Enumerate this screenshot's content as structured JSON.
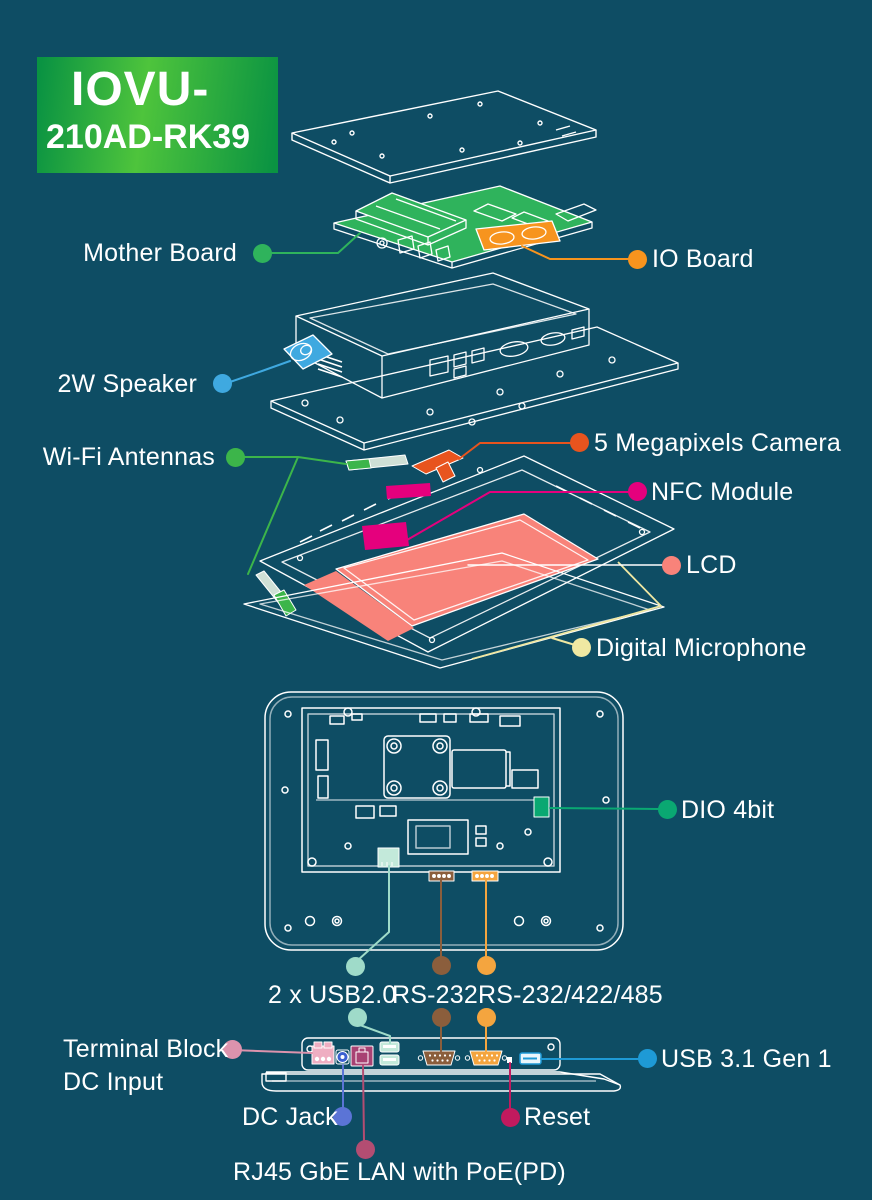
{
  "product_badge": {
    "model_line1": "IOVU-",
    "model_line2": "210AD-RK39"
  },
  "colors": {
    "background": "#0e4d64",
    "line_art": "#ffffff",
    "badge_edge_green": "#0a9342",
    "badge_center_green": "#4ec43c",
    "pcb_green": "#2fb35c",
    "io_orange": "#f7941e",
    "speaker_blue": "#3fa9e0",
    "wifi_green": "#3cb54a",
    "antenna_pale": "#cfe0d6",
    "camera_orange": "#e8541e",
    "nfc_magenta": "#e5007d",
    "lcd_salmon": "#f8837a",
    "mic_yellow": "#f0e8a2",
    "dio_green": "#0aa872",
    "usb2_mint": "#9fdbc9",
    "usb2_port_mint": "#c3e9da",
    "rs232_brown": "#8b5e3c",
    "rs422_orange": "#f4a53f",
    "terminal_pink": "#dc93ad",
    "terminal_port_pink": "#efaec2",
    "dc_jack_blue": "#5b74d6",
    "dc_port_blue": "#3a5fd0",
    "rj45_mauve": "#b34d72",
    "rj45_port": "#a84273",
    "reset_crimson": "#c11a5e",
    "usb31_blue": "#1e9ad6"
  },
  "labels": {
    "mother_board": "Mother Board",
    "io_board": "IO Board",
    "speaker": "2W Speaker",
    "wifi": "Wi-Fi Antennas",
    "camera": "5 Megapixels Camera",
    "nfc": "NFC Module",
    "lcd": "LCD",
    "microphone": "Digital Microphone",
    "dio": "DIO 4bit",
    "usb2": "2 x USB2.0",
    "rs232": "RS-232",
    "rs422": "RS-232/422/485",
    "terminal_line1": "Terminal Block",
    "terminal_line2": "DC Input",
    "dc_jack": "DC Jack",
    "rj45": "RJ45 GbE LAN with PoE(PD)",
    "reset": "Reset",
    "usb31": "USB 3.1 Gen 1"
  }
}
